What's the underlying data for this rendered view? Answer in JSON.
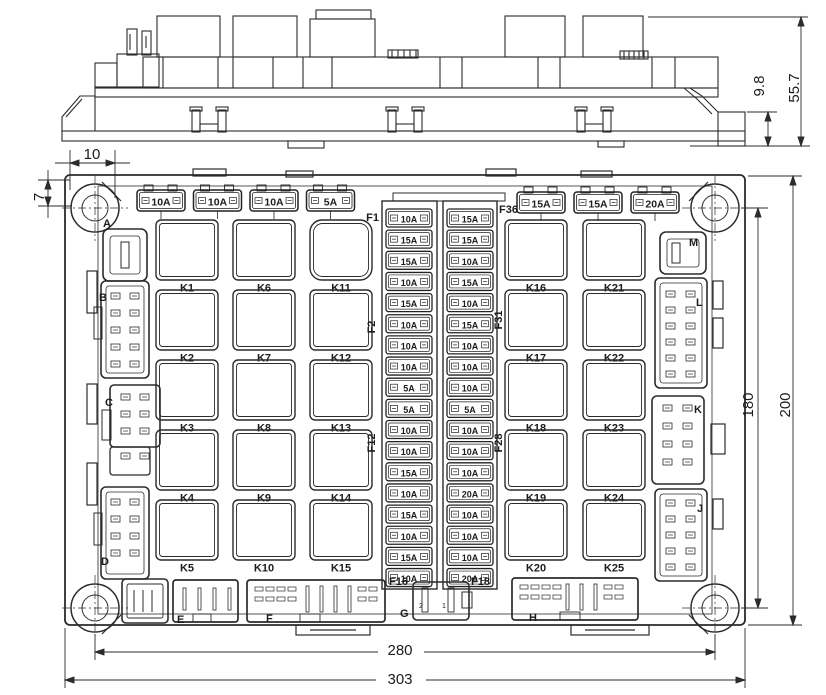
{
  "drawing": {
    "type": "fuse-relay-box engineering drawing",
    "views": [
      "side elevation",
      "front view"
    ]
  },
  "dimensions": {
    "side_view": {
      "step_height": "9.8",
      "total_height": "55.7"
    },
    "front_view": {
      "hole_offset_top": "10",
      "hole_offset_side": "7",
      "hole_pitch_vertical": "180",
      "body_height": "200",
      "hole_pitch_horizontal": "280",
      "body_width": "303"
    }
  },
  "top_fuse_row": {
    "left": [
      "10A",
      "10A",
      "10A",
      "5A"
    ],
    "right": [
      "15A",
      "15A",
      "20A"
    ]
  },
  "center_fuse_columns": {
    "left_labels": {
      "top": "F1",
      "mid": "F2",
      "low": "F12",
      "bottom": "F16"
    },
    "right_labels": {
      "top": "F36",
      "mid": "F31",
      "low": "F28",
      "bottom": "F18"
    },
    "left": [
      "10A",
      "15A",
      "15A",
      "10A",
      "15A",
      "10A",
      "10A",
      "10A",
      "5A",
      "5A",
      "10A",
      "10A",
      "15A",
      "10A",
      "15A",
      "10A",
      "15A",
      "10A"
    ],
    "right": [
      "15A",
      "15A",
      "10A",
      "15A",
      "10A",
      "15A",
      "10A",
      "10A",
      "10A",
      "5A",
      "10A",
      "10A",
      "10A",
      "20A",
      "10A",
      "10A",
      "10A",
      "20A"
    ]
  },
  "relays": {
    "columns": [
      [
        "K1",
        "K2",
        "K3",
        "K4",
        "K5"
      ],
      [
        "K6",
        "K7",
        "K8",
        "K9",
        "K10"
      ],
      [
        "K11",
        "K12",
        "K13",
        "K14",
        "K15"
      ],
      [
        "K16",
        "K17",
        "K18",
        "K19",
        "K20"
      ],
      [
        "K21",
        "K22",
        "K23",
        "K24",
        "K25"
      ]
    ]
  },
  "connectors": {
    "left": [
      "A",
      "B",
      "C",
      "D"
    ],
    "right": [
      "M",
      "L",
      "K",
      "J"
    ],
    "bottom": [
      "E",
      "F",
      "G",
      "H"
    ],
    "g_pin_numbers": [
      "2",
      "1"
    ]
  }
}
